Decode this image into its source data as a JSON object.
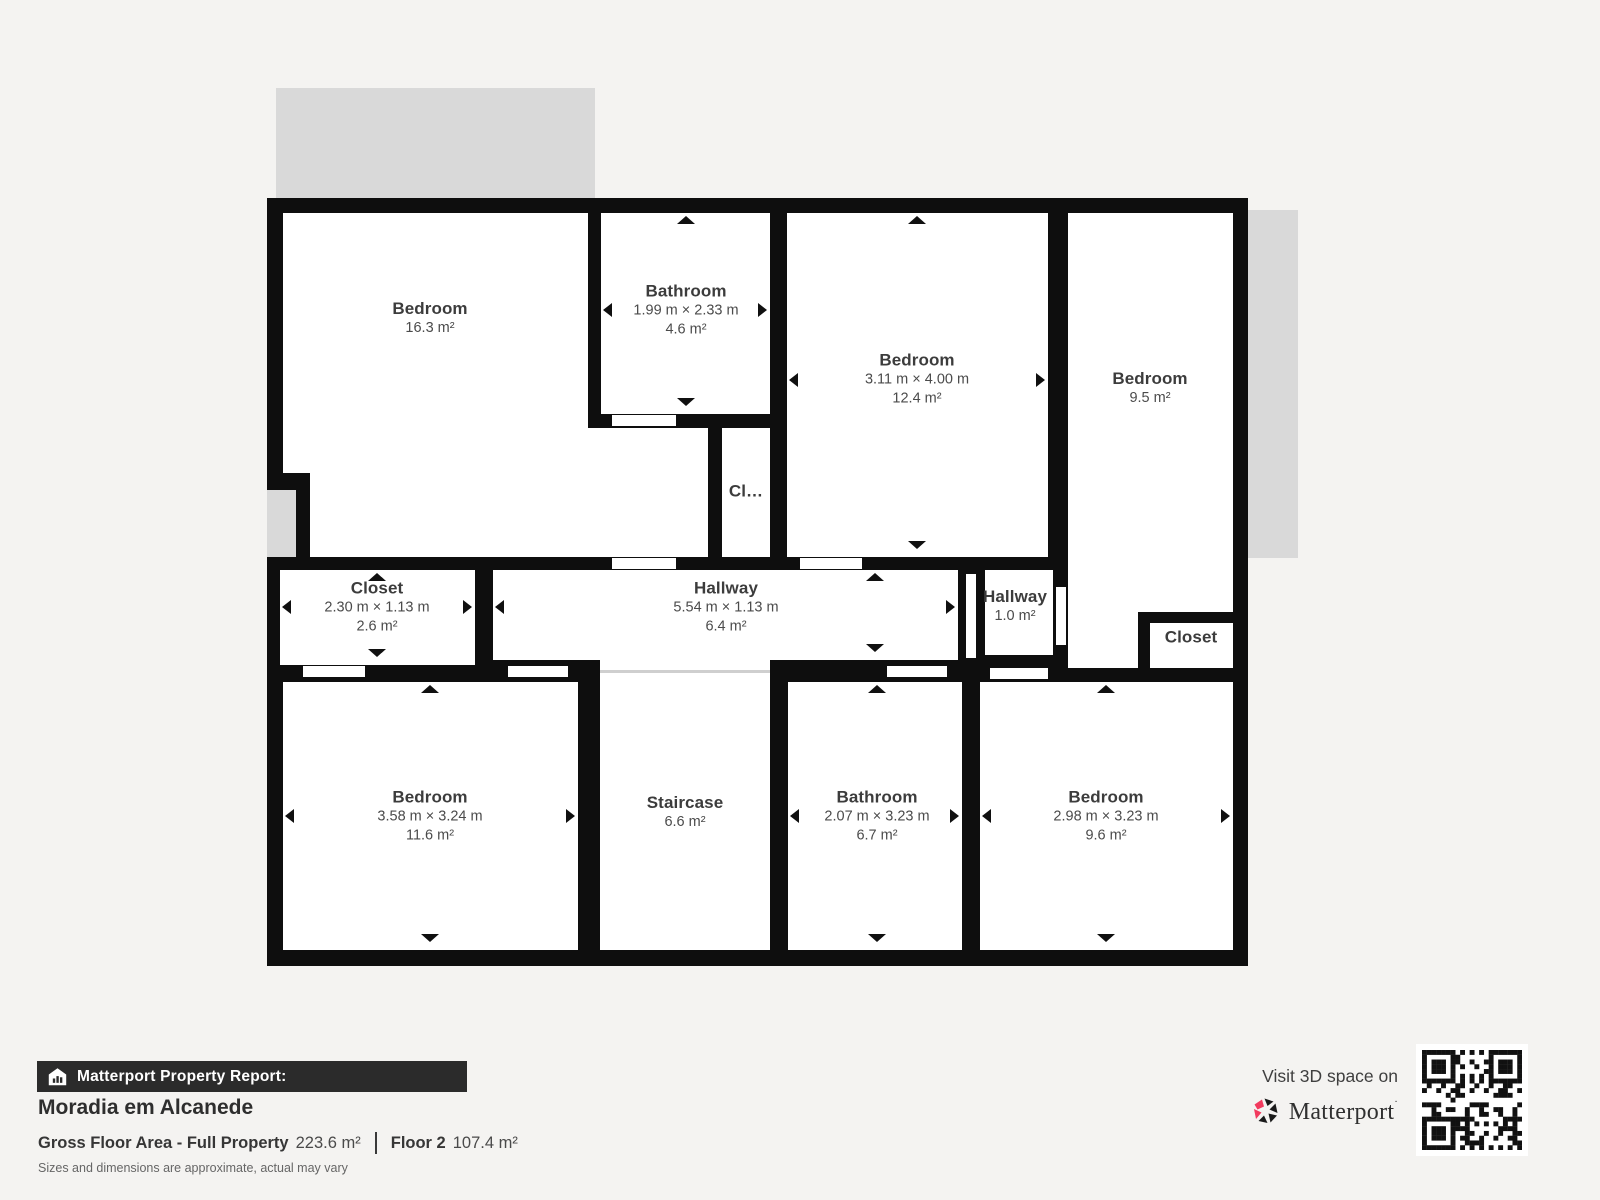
{
  "plan": {
    "rooms": [
      {
        "id": "bedroom-top-left",
        "name": "Bedroom",
        "area": "16.3 m²"
      },
      {
        "id": "bathroom-top",
        "name": "Bathroom",
        "dims": "1.99 m × 2.33 m",
        "area": "4.6 m²"
      },
      {
        "id": "bedroom-middle",
        "name": "Bedroom",
        "dims": "3.11 m × 4.00 m",
        "area": "12.4 m²"
      },
      {
        "id": "bedroom-right",
        "name": "Bedroom",
        "area": "9.5 m²"
      },
      {
        "id": "closet-small",
        "name": "Cl…"
      },
      {
        "id": "closet-left",
        "name": "Closet",
        "dims": "2.30 m × 1.13 m",
        "area": "2.6 m²"
      },
      {
        "id": "hallway-main",
        "name": "Hallway",
        "dims": "5.54 m × 1.13 m",
        "area": "6.4 m²"
      },
      {
        "id": "hallway-small",
        "name": "Hallway",
        "area": "1.0 m²"
      },
      {
        "id": "closet-right",
        "name": "Closet"
      },
      {
        "id": "bedroom-bottom-left",
        "name": "Bedroom",
        "dims": "3.58 m × 3.24 m",
        "area": "11.6 m²"
      },
      {
        "id": "staircase",
        "name": "Staircase",
        "area": "6.6 m²"
      },
      {
        "id": "bathroom-bottom",
        "name": "Bathroom",
        "dims": "2.07 m × 3.23 m",
        "area": "6.7 m²"
      },
      {
        "id": "bedroom-bottom-right",
        "name": "Bedroom",
        "dims": "2.98 m × 3.23 m",
        "area": "9.6 m²"
      }
    ]
  },
  "footer": {
    "report_label": "Matterport Property Report:",
    "property_name": "Moradia em Alcanede",
    "gfa_label": "Gross Floor Area - Full Property",
    "gfa_value": "223.6 m²",
    "floor_label": "Floor 2",
    "floor_value": "107.4 m²",
    "disclaimer": "Sizes and dimensions are approximate, actual may vary",
    "visit_label": "Visit 3D space on",
    "brand": "Matterport"
  },
  "colors": {
    "accent_pink": "#f23a5e",
    "wall": "#0e0e0e",
    "exterior_gray": "#d9d9d9"
  }
}
